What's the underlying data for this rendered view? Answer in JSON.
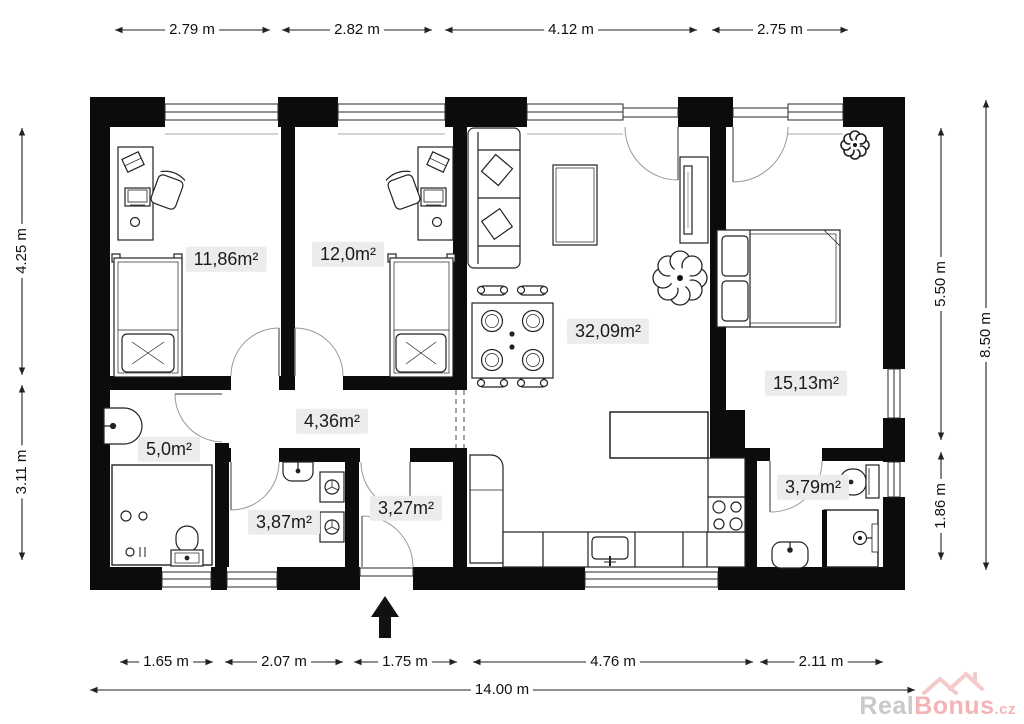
{
  "plan": {
    "rooms": [
      {
        "id": "bedroom-1",
        "area_label": "11,86m²"
      },
      {
        "id": "bedroom-2",
        "area_label": "12,0m²"
      },
      {
        "id": "living-room",
        "area_label": "32,09m²"
      },
      {
        "id": "bedroom-3",
        "area_label": "15,13m²"
      },
      {
        "id": "bathroom-1",
        "area_label": "5,0m²"
      },
      {
        "id": "hallway",
        "area_label": "4,36m²"
      },
      {
        "id": "utility-room",
        "area_label": "3,87m²"
      },
      {
        "id": "entry",
        "area_label": "3,27m²"
      },
      {
        "id": "bathroom-2",
        "area_label": "3,79m²"
      }
    ],
    "dimensions": {
      "top": [
        "2.79 m",
        "2.82 m",
        "4.12 m",
        "2.75 m"
      ],
      "left": [
        "4.25 m",
        "3.11 m"
      ],
      "right": [
        "5.50 m",
        "8.50 m",
        "1.86 m"
      ],
      "bottom": [
        "1.65 m",
        "2.07 m",
        "1.75 m",
        "4.76 m",
        "2.11 m"
      ],
      "total_width": "14.00 m"
    },
    "colors": {
      "wall": "#0c0c0c",
      "dimension_line": "#222222",
      "label_background": "#ececec",
      "watermark_gray": "#c9c9c9",
      "watermark_pink": "#f2b4b4"
    }
  },
  "watermark": {
    "brand_gray": "Real",
    "brand_pink": "Bonus",
    "brand_suffix": ".cz"
  }
}
